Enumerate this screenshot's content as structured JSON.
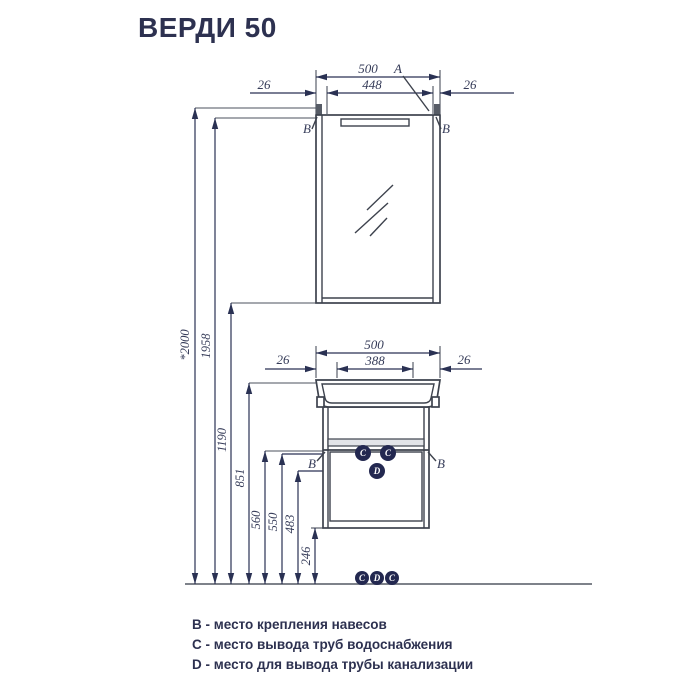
{
  "title": "ВЕРДИ 50",
  "colors": {
    "accent": "#232850",
    "line": "#3d424d",
    "text": "#2d3150"
  },
  "mirror": {
    "total": "500",
    "inner": "448",
    "gap_left": "26",
    "gap_right": "26",
    "a": "A",
    "b_left": "B",
    "b_right": "B"
  },
  "vanity": {
    "total": "500",
    "inner": "388",
    "gap_left": "26",
    "gap_right": "26",
    "b_left": "B",
    "b_right": "B",
    "port_c1": "C",
    "port_c2": "C",
    "port_d": "D"
  },
  "heights": {
    "total": "*2000",
    "mirror_top": "1958",
    "mirror_bottom": "1190",
    "sink_top": "851",
    "supply": "560",
    "door_top": "550",
    "drain": "483",
    "plinth": "246"
  },
  "floor_ports": [
    "C",
    "D",
    "C"
  ],
  "legend": [
    "B - место крепления навесов",
    "C - место вывода труб водоснабжения",
    "D - место для вывода трубы канализации"
  ]
}
